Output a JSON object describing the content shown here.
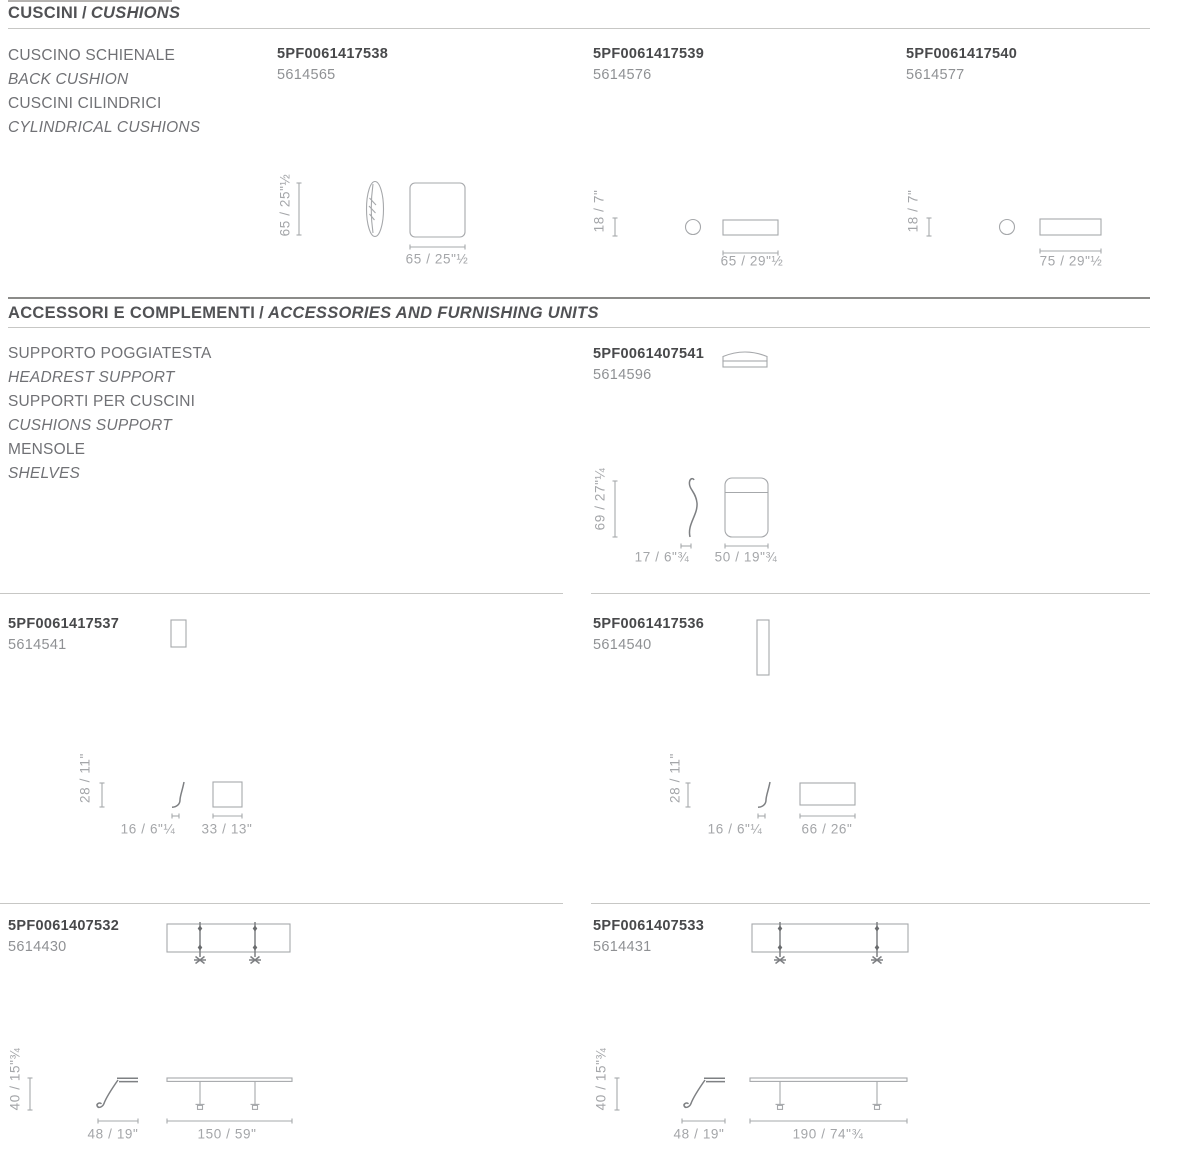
{
  "colors": {
    "title_text": "#515255",
    "category_text": "#707175",
    "code_text": "#48494b",
    "sku_text": "#8f9194",
    "dimension_text": "#a4a6a9",
    "drawing_stroke": "#a6a8ab",
    "divider_light": "#c7c7c5",
    "divider_dark": "#8b8b89"
  },
  "sections": {
    "cushions": {
      "title_it": "CUSCINI",
      "title_sep": "/",
      "title_en": "CUSHIONS",
      "category": [
        "CUSCINO SCHIENALE",
        "BACK CUSHION",
        "CUSCINI CILINDRICI",
        "CYLINDRICAL CUSHIONS"
      ],
      "products": {
        "back_cushion": {
          "code": "5PF0061417538",
          "sku": "5614565",
          "height": "65 / 25\"½",
          "width": "65 / 25\"½"
        },
        "cylindrical_cushion_65": {
          "code": "5PF0061417539",
          "sku": "5614576",
          "height": "18 / 7\"",
          "width": "65 / 29\"½"
        },
        "cylindrical_cushion_75": {
          "code": "5PF0061417540",
          "sku": "5614577",
          "height": "18 / 7\"",
          "width": "75 / 29\"½"
        }
      }
    },
    "accessories": {
      "title_it": "ACCESSORI E COMPLEMENTI",
      "title_sep": "/",
      "title_en": "ACCESSORIES AND FURNISHING UNITS",
      "category": [
        "SUPPORTO POGGIATESTA",
        "HEADREST SUPPORT",
        "SUPPORTI PER CUSCINI",
        "CUSHIONS SUPPORT",
        "MENSOLE",
        "SHELVES"
      ],
      "products": {
        "headrest_support": {
          "code": "5PF0061407541",
          "sku": "5614596",
          "height": "69 / 27\"¼",
          "depth": "17 / 6\"¾",
          "width": "50 / 19\"¾"
        },
        "cushion_support_33": {
          "code": "5PF0061417537",
          "sku": "5614541",
          "height": "28 / 11\"",
          "depth": "16 / 6\"¼",
          "width": "33 / 13\""
        },
        "cushion_support_66": {
          "code": "5PF0061417536",
          "sku": "5614540",
          "height": "28 / 11\"",
          "depth": "16 / 6\"¼",
          "width": "66 / 26\""
        },
        "shelf_150": {
          "code": "5PF0061407532",
          "sku": "5614430",
          "height": "40 / 15\"¾",
          "depth": "48 / 19\"",
          "width": "150 / 59\""
        },
        "shelf_190": {
          "code": "5PF0061407533",
          "sku": "5614431",
          "height": "40 / 15\"¾",
          "depth": "48 / 19\"",
          "width": "190 / 74\"¾"
        }
      }
    }
  }
}
